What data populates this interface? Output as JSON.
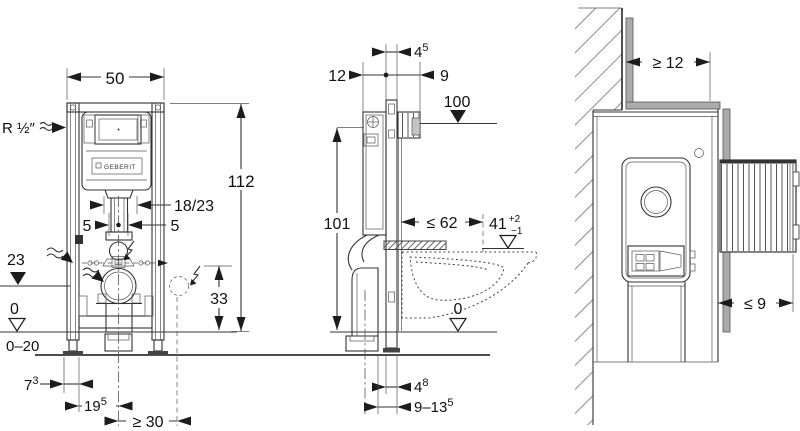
{
  "drawing": {
    "front": {
      "width": "50",
      "supply_label": "R ½″",
      "height": "112",
      "bend_label": "18/23",
      "left_offset": "5",
      "right_offset": "5",
      "outlet_level": "23",
      "floor_level": "0",
      "floor_adjust": "0–20",
      "connection_height": "33",
      "foot_offset": {
        "base": "7",
        "sup": "3"
      },
      "outlet_distance": {
        "base": "19",
        "sup": "5"
      },
      "socket_distance": "≥ 30",
      "logo": "GEBERIT"
    },
    "side": {
      "rail_depth": {
        "base": "4",
        "sup": "5"
      },
      "cistern_depth": "12",
      "box_depth": "9",
      "plate_height": "100",
      "frame_height": "101",
      "pan_depth": "≤ 62",
      "pan_height": {
        "base": "41",
        "sup": "+2",
        "sub": "−1"
      },
      "floor_level": "0",
      "rail_depth_floor": {
        "base": "4",
        "sup": "8"
      },
      "pipe_range": {
        "base": "9–13",
        "sup": "5"
      }
    },
    "plan": {
      "corner_distance": "≥ 12",
      "cladding_depth": "≤ 9"
    },
    "colors": {
      "line": "#333333",
      "wall_gray": "#ababab",
      "accent_dark": "#1c1c1c"
    }
  }
}
